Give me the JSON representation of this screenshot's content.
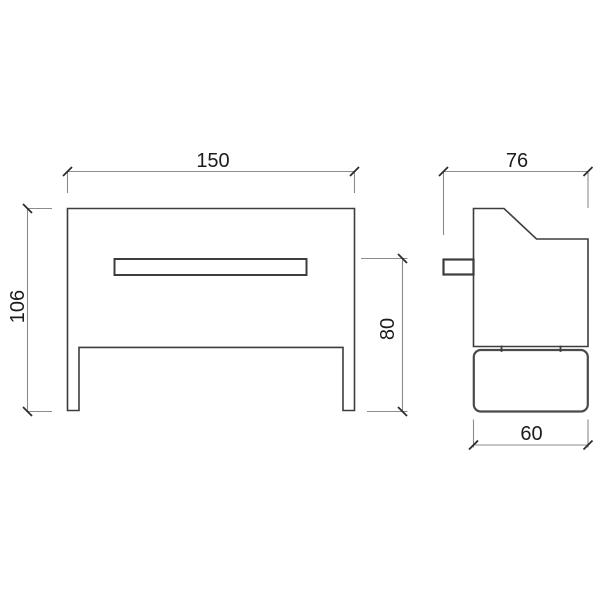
{
  "colors": {
    "background": "#ffffff",
    "object_line": "#3d3d3d",
    "heavy_line": "#4a4a4a",
    "dimension_line": "#8c8c8c",
    "tick": "#2d2d2d",
    "text": "#1c1c1c"
  },
  "dimensions": {
    "front_width": {
      "label": "150",
      "value": 150
    },
    "front_height": {
      "label": "106",
      "value": 106
    },
    "seat_height": {
      "label": "80",
      "value": 80
    },
    "side_depth": {
      "label": "76",
      "value": 76
    },
    "base_depth": {
      "label": "60",
      "value": 60
    }
  }
}
